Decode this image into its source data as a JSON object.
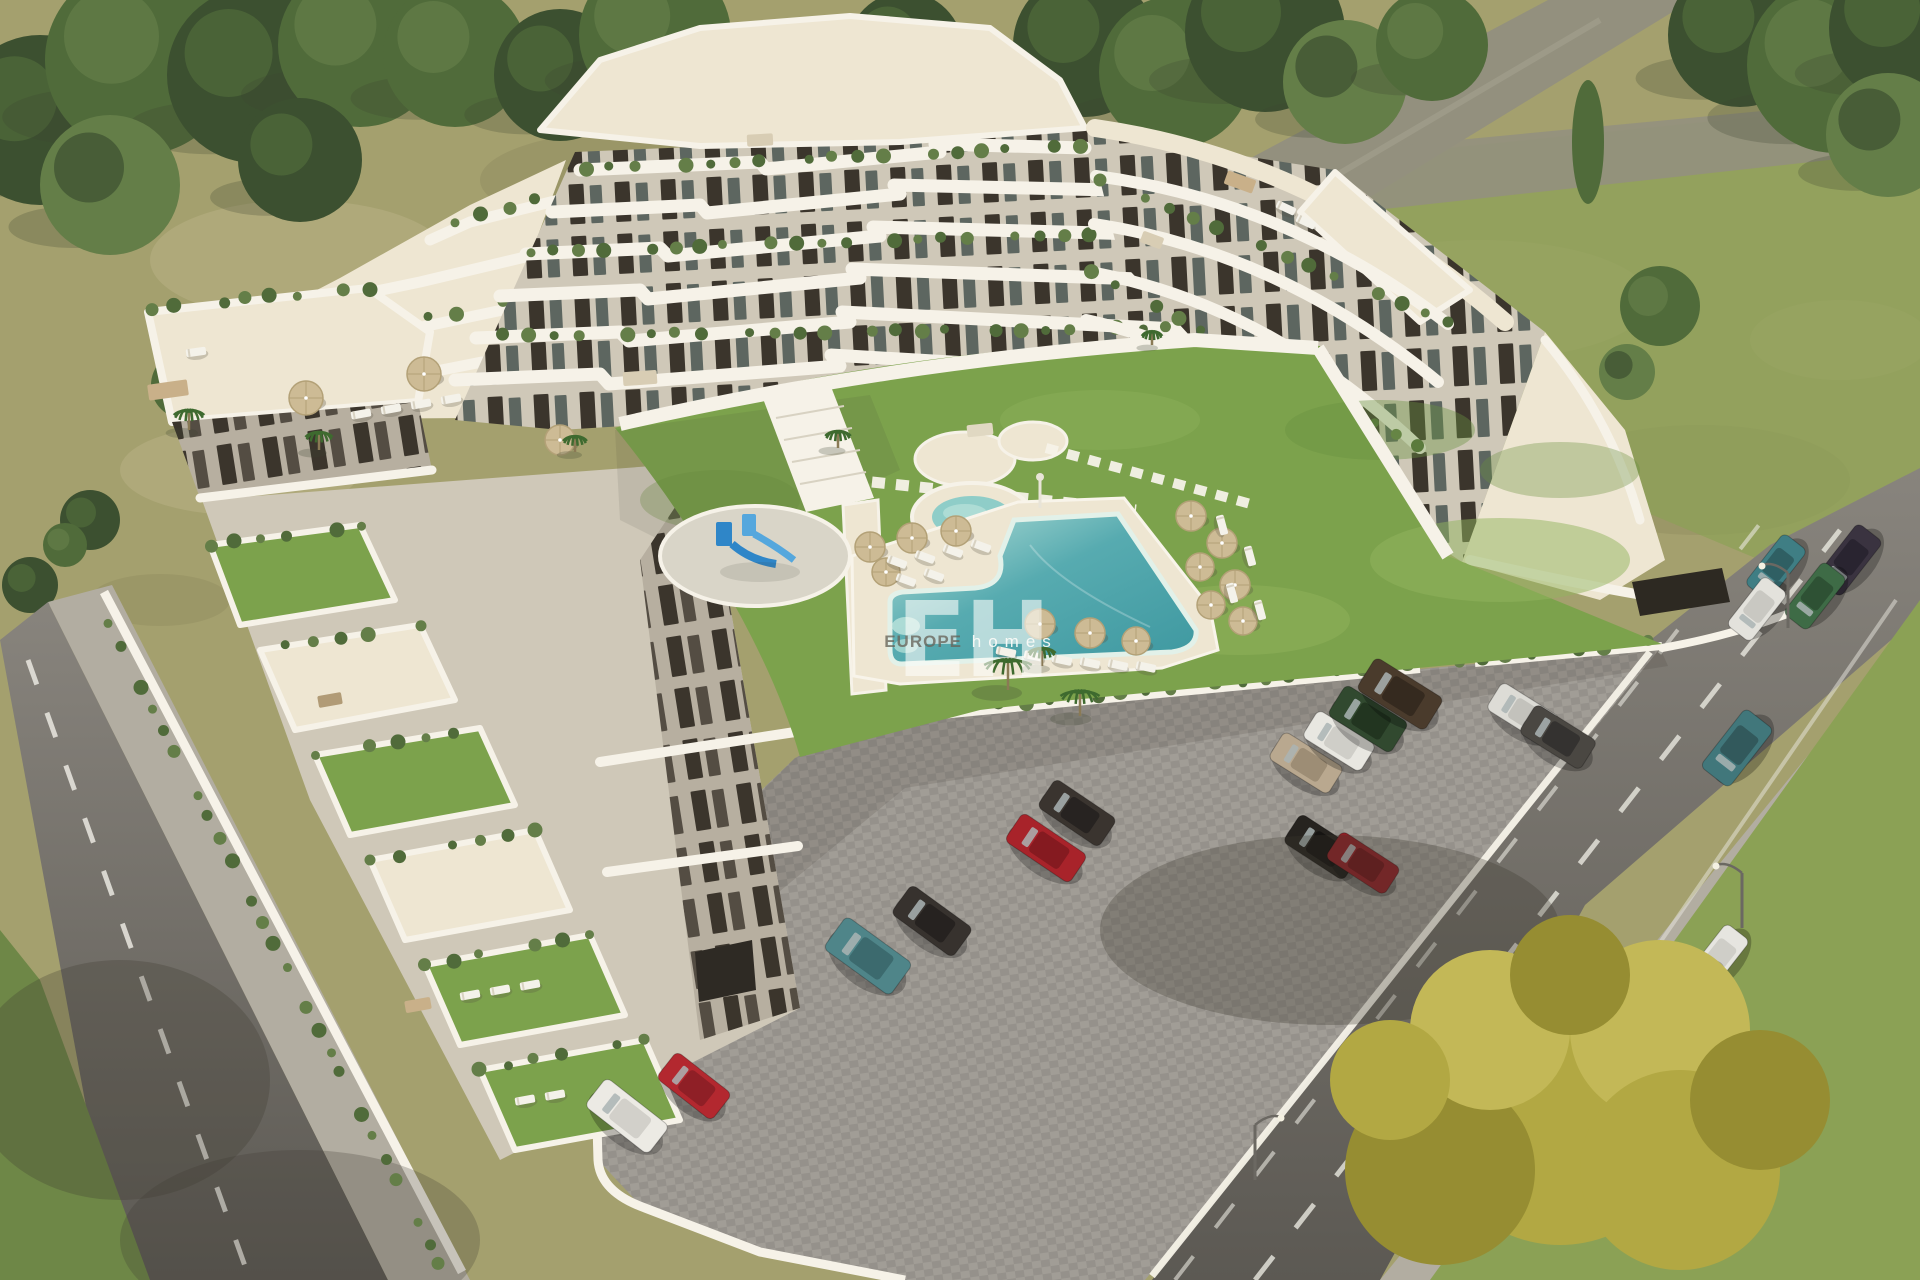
{
  "image_type": "aerial-architectural-render",
  "watermark": {
    "initials": "EH",
    "brand_primary": "EUROPE",
    "brand_secondary": "homes"
  },
  "palette": {
    "field": "#a4a06e",
    "fieldLight": "#bab285",
    "fieldDark": "#8b885c",
    "grassRight": "#8ba155",
    "lawn": "#7ca24c",
    "lawnLight": "#92b45e",
    "lawnDark": "#6a9040",
    "tree0": "#3c5030",
    "tree1": "#506b3a",
    "tree2": "#647e48",
    "treeShadow": "#3c422e",
    "palm": "#3e6a2f",
    "asphalt": "#88847d",
    "asphaltDark": "#5c5953",
    "laneWhite": "#eae8e0",
    "sidewalk": "#b2ada1",
    "cobble": "#a19d96",
    "cobbleDark": "#8b8781",
    "wallWhite": "#f6f2e8",
    "deck": "#eee6d2",
    "wallLight": "#cfc8b8",
    "wallShade": "#b7afa0",
    "windowDark": "#3b352c",
    "glass": "#5d6660",
    "poolDeep": "#3e98a0",
    "poolMid": "#57abb0",
    "poolShallow": "#b9e2da",
    "poolRim": "#e2f1e9",
    "kiddie": "#8fcdc8",
    "umbrella": "#cdbb95",
    "umbrellaDark": "#b3a177",
    "slideBlue": "#2f86c8",
    "slideBlue2": "#55a7dd",
    "playPad": "#d9d5c8",
    "yellow0": "#b2a843",
    "yellow1": "#c3b857",
    "yellow2": "#968d32",
    "shadow": "#3c382e"
  },
  "scene": {
    "patches": [
      [
        300,
        260,
        150,
        60,
        "fieldLight",
        0.5
      ],
      [
        640,
        180,
        160,
        50,
        "fieldDark",
        0.4
      ],
      [
        1030,
        140,
        120,
        40,
        "fieldLight",
        0.45
      ],
      [
        1480,
        300,
        170,
        60,
        "fieldLight",
        0.4
      ],
      [
        1700,
        480,
        150,
        55,
        "fieldDark",
        0.35
      ],
      [
        240,
        470,
        120,
        45,
        "fieldLight",
        0.5
      ],
      [
        980,
        240,
        90,
        30,
        "fieldDark",
        0.3
      ],
      [
        1840,
        340,
        90,
        40,
        "fieldLight",
        0.4
      ],
      [
        160,
        600,
        70,
        26,
        "fieldDark",
        0.35
      ]
    ],
    "lawnPatches": [
      [
        1500,
        560,
        130,
        42,
        "lawnLight",
        0.5
      ],
      [
        1380,
        430,
        95,
        30,
        "lawnDark",
        0.4
      ],
      [
        1240,
        620,
        110,
        35,
        "lawnLight",
        0.45
      ],
      [
        1560,
        470,
        80,
        28,
        "lawnDark",
        0.35
      ],
      [
        720,
        500,
        80,
        30,
        "lawnDark",
        0.3
      ],
      [
        1100,
        420,
        100,
        30,
        "lawnLight",
        0.35
      ]
    ],
    "trees": [
      [
        40,
        120,
        85,
        0
      ],
      [
        140,
        60,
        95,
        1
      ],
      [
        255,
        75,
        88,
        0
      ],
      [
        360,
        45,
        82,
        1
      ],
      [
        110,
        185,
        70,
        2
      ],
      [
        300,
        160,
        62,
        0
      ],
      [
        455,
        55,
        72,
        1
      ],
      [
        560,
        75,
        66,
        0
      ],
      [
        655,
        35,
        76,
        1
      ],
      [
        745,
        85,
        58,
        2
      ],
      [
        905,
        50,
        58,
        0
      ],
      [
        965,
        95,
        44,
        1
      ],
      [
        1085,
        45,
        72,
        0
      ],
      [
        1175,
        72,
        76,
        1
      ],
      [
        1265,
        32,
        80,
        0
      ],
      [
        1345,
        82,
        62,
        2
      ],
      [
        1432,
        45,
        56,
        1
      ],
      [
        1740,
        35,
        72,
        0
      ],
      [
        1835,
        65,
        88,
        1
      ],
      [
        1905,
        28,
        76,
        0
      ],
      [
        1888,
        135,
        62,
        2
      ],
      [
        1660,
        306,
        40,
        1
      ],
      [
        1627,
        372,
        28,
        2
      ],
      [
        185,
        385,
        34,
        1
      ],
      [
        90,
        520,
        30,
        0
      ],
      [
        30,
        585,
        28,
        0
      ],
      [
        65,
        545,
        22,
        1
      ]
    ],
    "cars": [
      [
        1776,
        567,
        -52,
        64,
        30,
        "#3f7e84",
        "#2f5f63"
      ],
      [
        1849,
        560,
        -52,
        70,
        32,
        "#3a3340",
        "#292430"
      ],
      [
        1815,
        596,
        -52,
        66,
        30,
        "#3e6b46",
        "#2e5134"
      ],
      [
        1757,
        609,
        -52,
        62,
        30,
        "#e3e2dc",
        "#c9c8c2"
      ],
      [
        1737,
        748,
        -52,
        74,
        36,
        "#41777b",
        "#32595c"
      ],
      [
        1718,
        958,
        -52,
        66,
        30,
        "#e6e5e0",
        "#cfcec8"
      ],
      [
        1692,
        990,
        -52,
        66,
        30,
        "#c3c2bd",
        "#a8a7a2"
      ],
      [
        627,
        1116,
        38,
        80,
        36,
        "#eceae4",
        "#d2d0ca"
      ],
      [
        694,
        1086,
        38,
        70,
        34,
        "#b3282f",
        "#8f1f26"
      ],
      [
        868,
        956,
        36,
        82,
        40,
        "#4f8589",
        "#3c6a6e"
      ],
      [
        932,
        921,
        36,
        76,
        36,
        "#37322e",
        "#262220"
      ],
      [
        1046,
        848,
        34,
        78,
        34,
        "#a8232a",
        "#851a20"
      ],
      [
        1077,
        813,
        34,
        74,
        34,
        "#3a342f",
        "#272321"
      ],
      [
        1322,
        847,
        33,
        72,
        34,
        "#26231f",
        "#161412"
      ],
      [
        1363,
        863,
        33,
        70,
        32,
        "#8c2026",
        "#6d161b"
      ],
      [
        1306,
        763,
        32,
        70,
        32,
        "#b9a88f",
        "#9d8d75"
      ],
      [
        1339,
        741,
        32,
        68,
        32,
        "#e8e7e1",
        "#cfcec8"
      ],
      [
        1368,
        719,
        32,
        74,
        36,
        "#31492f",
        "#223520"
      ],
      [
        1400,
        694,
        32,
        80,
        38,
        "#4a3b2c",
        "#352a1f"
      ],
      [
        1523,
        713,
        32,
        68,
        32,
        "#dddcd6",
        "#c3c2bc"
      ],
      [
        1558,
        737,
        32,
        72,
        34,
        "#4a4742",
        "#343230"
      ]
    ],
    "umbrellas": [
      [
        870,
        547,
        15
      ],
      [
        912,
        538,
        15
      ],
      [
        956,
        531,
        15
      ],
      [
        886,
        572,
        14
      ],
      [
        1191,
        516,
        15
      ],
      [
        1222,
        543,
        15
      ],
      [
        1200,
        567,
        14
      ],
      [
        1235,
        585,
        15
      ],
      [
        1211,
        605,
        14
      ],
      [
        1243,
        621,
        14
      ],
      [
        1040,
        624,
        15
      ],
      [
        1090,
        633,
        15
      ],
      [
        1136,
        641,
        14
      ],
      [
        306,
        398,
        17
      ],
      [
        424,
        374,
        17
      ],
      [
        560,
        440,
        15
      ]
    ],
    "loungers": [
      [
        897,
        562,
        20
      ],
      [
        925,
        557,
        20
      ],
      [
        953,
        551,
        20
      ],
      [
        981,
        546,
        20
      ],
      [
        906,
        580,
        20
      ],
      [
        934,
        575,
        20
      ],
      [
        1006,
        652,
        12
      ],
      [
        1034,
        656,
        12
      ],
      [
        1062,
        660,
        12
      ],
      [
        1090,
        663,
        12
      ],
      [
        1118,
        665,
        12
      ],
      [
        1146,
        667,
        12
      ],
      [
        1222,
        525,
        75
      ],
      [
        1250,
        556,
        75
      ],
      [
        1232,
        593,
        75
      ],
      [
        1260,
        610,
        75
      ],
      [
        361,
        414,
        -10
      ],
      [
        391,
        409,
        -10
      ],
      [
        421,
        404,
        -10
      ],
      [
        451,
        399,
        -10
      ],
      [
        470,
        995,
        -10
      ],
      [
        500,
        990,
        -10
      ],
      [
        530,
        985,
        -10
      ],
      [
        525,
        1100,
        -10
      ],
      [
        555,
        1095,
        -10
      ],
      [
        196,
        352,
        -8
      ],
      [
        1286,
        208,
        25
      ],
      [
        1306,
        222,
        25
      ]
    ],
    "palms": [
      [
        1008,
        690,
        28
      ],
      [
        1080,
        716,
        23
      ],
      [
        1042,
        666,
        16
      ],
      [
        838,
        448,
        15
      ],
      [
        189,
        430,
        18
      ],
      [
        319,
        450,
        16
      ],
      [
        575,
        452,
        14
      ],
      [
        1152,
        345,
        12
      ]
    ],
    "furniture": [
      [
        168,
        390,
        40,
        16,
        "#c9b089",
        -8
      ],
      [
        640,
        378,
        34,
        14,
        "#d8cdb4",
        -4
      ],
      [
        1240,
        182,
        30,
        14,
        "#c9b089",
        20
      ],
      [
        1152,
        240,
        22,
        12,
        "#d8cdb4",
        20
      ],
      [
        418,
        1005,
        26,
        12,
        "#c9b089",
        -10
      ],
      [
        330,
        700,
        24,
        12,
        "#b19b76",
        -10
      ],
      [
        980,
        430,
        26,
        12,
        "#e0d8c2",
        -6
      ],
      [
        760,
        140,
        26,
        12,
        "#d8cdb4",
        -3
      ]
    ],
    "lights": [
      [
        1742,
        928,
        -1
      ],
      [
        1788,
        628,
        -1
      ],
      [
        1255,
        1180,
        1
      ]
    ]
  }
}
